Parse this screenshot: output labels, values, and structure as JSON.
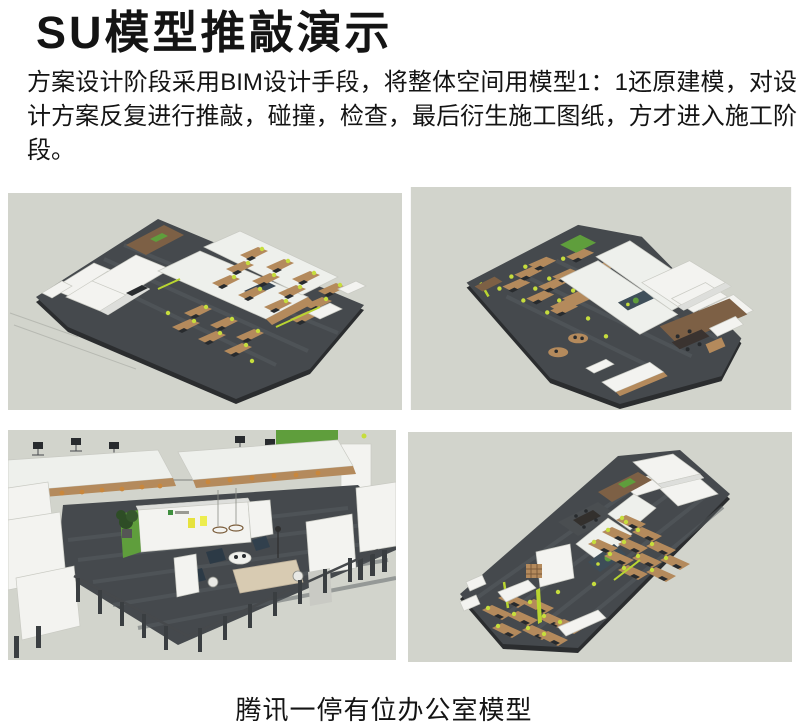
{
  "title": "SU模型推敲演示",
  "paragraph": "方案设计阶段采用BIM设计手段，将整体空间用模型1：1还原建模，对设计方案反复进行推敲，碰撞，检查，最后衍生施工图纸，方才进入施工阶段。",
  "caption": "腾讯一停有位办公室模型",
  "colors": {
    "page_bg": "#ffffff",
    "text": "#141414",
    "render_canvas": "#d2d4cc",
    "floor_dark": "#45494d",
    "floor_edge": "#2b2d2f",
    "wall_white": "#f3f3f0",
    "wall_line": "#c9cac3",
    "wood": "#b48a5c",
    "wood_dark": "#7d6045",
    "accent_green": "#c6dd3d",
    "plant_green": "#5f9e3c",
    "dark_object": "#282b2e"
  }
}
